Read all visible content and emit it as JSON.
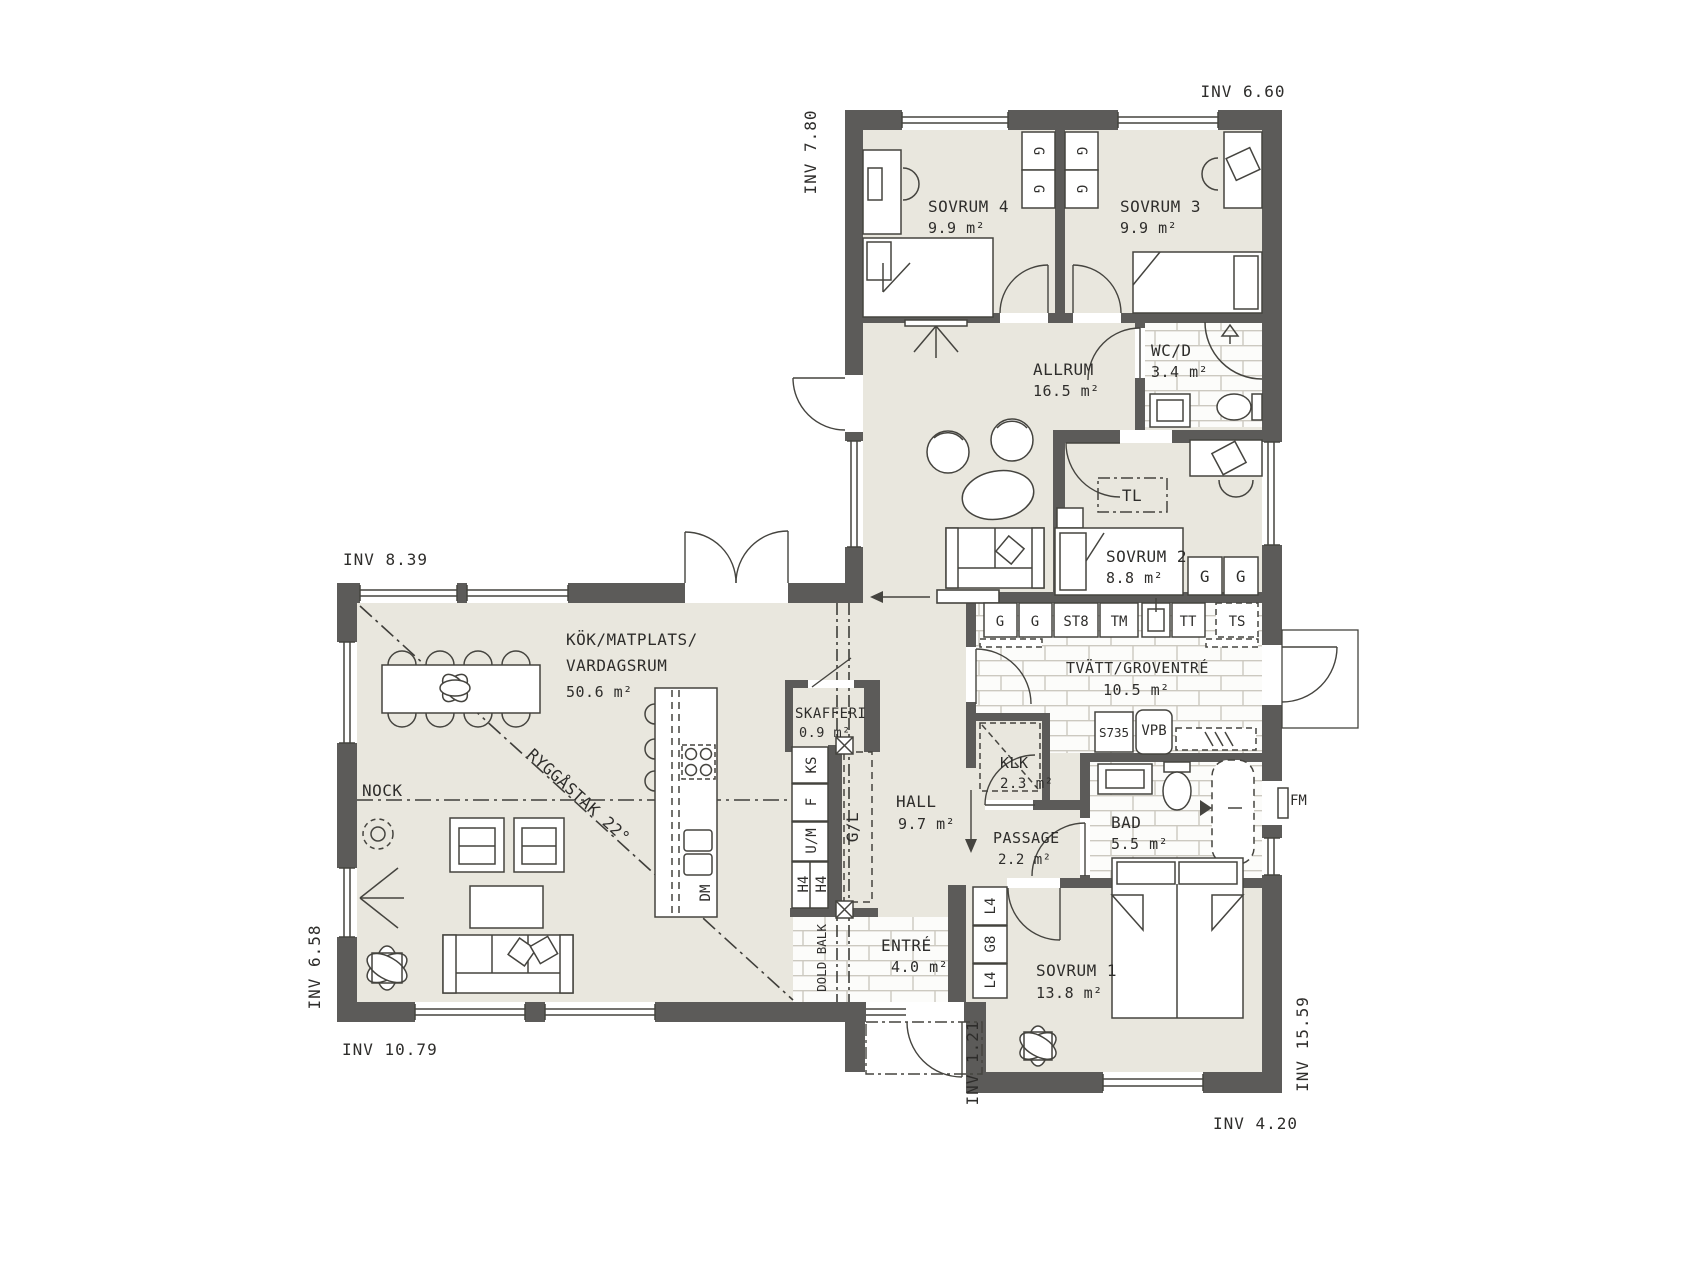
{
  "dims": {
    "top_right": "INV 6.60",
    "top_wing_left": "INV 7.80",
    "kitchen_top": "INV 8.39",
    "living_left": "INV 6.58",
    "bottom_left": "INV 10.79",
    "entry": "INV 1.21",
    "right": "INV 15.59",
    "bottom_right": "INV 4.20"
  },
  "rooms": {
    "sovrum4": {
      "name": "SOVRUM 4",
      "area": "9.9 m²"
    },
    "sovrum3": {
      "name": "SOVRUM 3",
      "area": "9.9 m²"
    },
    "allrum": {
      "name": "ALLRUM",
      "area": "16.5 m²"
    },
    "wcd": {
      "name": "WC/D",
      "area": "3.4 m²"
    },
    "sovrum2": {
      "name": "SOVRUM 2",
      "area": "8.8 m²"
    },
    "tvatt": {
      "name": "TVÄTT/GROVENTRÉ",
      "area": "10.5 m²"
    },
    "kok": {
      "name_line1": "KÖK/MATPLATS/",
      "name_line2": "VARDAGSRUM",
      "area": "50.6 m²"
    },
    "skafferi": {
      "name": "SKAFFERI",
      "area": "0.9 m²"
    },
    "hall": {
      "name": "HALL",
      "area": "9.7 m²"
    },
    "klk": {
      "name": "KLK",
      "area": "2.3 m²"
    },
    "passage": {
      "name": "PASSAGE",
      "area": "2.2 m²"
    },
    "bad": {
      "name": "BAD",
      "area": "5.5 m²"
    },
    "entre": {
      "name": "ENTRÉ",
      "area": "4.0 m²"
    },
    "sovrum1": {
      "name": "SOVRUM 1",
      "area": "13.8 m²"
    }
  },
  "annotations": {
    "nock": "NOCK",
    "ridge": "RYGGÅSTAK 22°",
    "dold_balk": "DOLD BALK",
    "tl": "TL",
    "gl": "G/L",
    "fm": "FM",
    "s735": "S735",
    "vpb": "VPB"
  },
  "units": {
    "g": "G",
    "st8": "ST8",
    "tm": "TM",
    "tt": "TT",
    "ts": "TS",
    "ks": "KS",
    "f": "F",
    "um": "U/M",
    "h4": "H4",
    "dm": "DM",
    "l4": "L4",
    "g8": "G8"
  },
  "colors": {
    "wall": "#5c5b59",
    "floor": "#e9e7de",
    "tile_grout": "#ccc9c0",
    "line": "#45443f",
    "text": "#2e2d2b"
  }
}
